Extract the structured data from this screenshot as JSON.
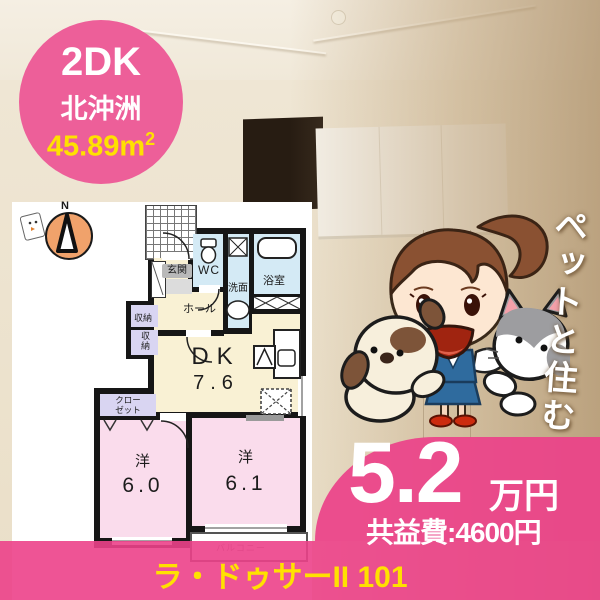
{
  "badge": {
    "layout_type": "2DK",
    "location": "北沖洲",
    "area": "45.89m",
    "area_sup": "2"
  },
  "floorplan": {
    "compass_n": "N",
    "genkan": "玄関",
    "wc": "WC",
    "senmen": "洗面",
    "bath": "浴室",
    "hall": "ホール",
    "shuno_a": "収納",
    "shuno_b": "収納",
    "closet_l1": "クロー",
    "closet_l2": "ゼット",
    "dk": "DK",
    "dk_size": "7.6",
    "west1": "洋",
    "west1_size": "6.0",
    "west2": "洋",
    "west2_size": "6.1",
    "balcony": "バルコニー"
  },
  "pet_banner": {
    "vertical_text": "ペットと住む"
  },
  "price": {
    "rent": "5.2",
    "unit": "万円",
    "fee": "共益費:4600円"
  },
  "footer": {
    "building_name": "ラ・ドゥサーII 101"
  },
  "colors": {
    "badge_pink": "#ed5f99",
    "overlay_pink": "#ec4189",
    "accent_yellow": "#ffe100",
    "cream_room": "#f9f1d4",
    "pink_room": "#fadcec",
    "blue_room": "#d4eaf5",
    "purple_room": "#d9d5f2"
  }
}
